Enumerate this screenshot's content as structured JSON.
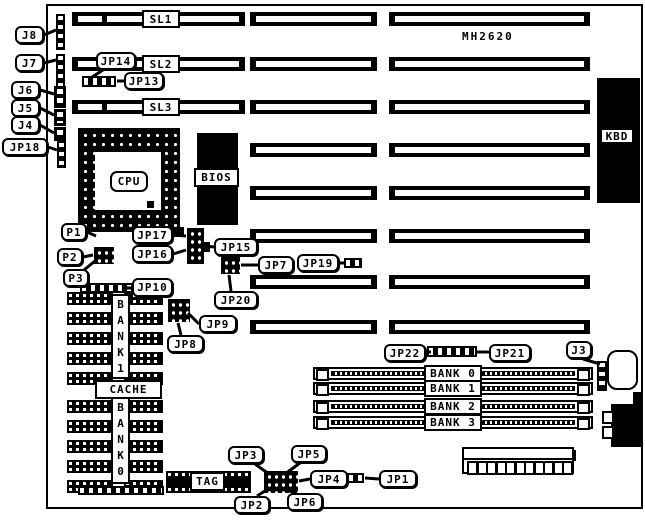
{
  "board": {
    "model": "MH2620"
  },
  "labels": {
    "cpu": "CPU",
    "bios": "BIOS",
    "kbd": "KBD",
    "cache": "CACHE",
    "tag": "TAG",
    "bank1_vertical": "BANK1",
    "bank0_vertical": "BANK0"
  },
  "slot_labels": [
    "SL1",
    "SL2",
    "SL3"
  ],
  "simm_banks": [
    "BANK 0",
    "BANK 1",
    "BANK 2",
    "BANK 3"
  ],
  "callouts": [
    {
      "id": "j8",
      "label": "J8"
    },
    {
      "id": "j7",
      "label": "J7"
    },
    {
      "id": "j6",
      "label": "J6"
    },
    {
      "id": "j5",
      "label": "J5"
    },
    {
      "id": "j4",
      "label": "J4"
    },
    {
      "id": "jp18",
      "label": "JP18"
    },
    {
      "id": "jp14",
      "label": "JP14"
    },
    {
      "id": "jp13",
      "label": "JP13"
    },
    {
      "id": "p1",
      "label": "P1"
    },
    {
      "id": "p2",
      "label": "P2"
    },
    {
      "id": "p3",
      "label": "P3"
    },
    {
      "id": "jp17",
      "label": "JP17"
    },
    {
      "id": "jp16",
      "label": "JP16"
    },
    {
      "id": "jp15",
      "label": "JP15"
    },
    {
      "id": "jp10",
      "label": "JP10"
    },
    {
      "id": "jp7",
      "label": "JP7"
    },
    {
      "id": "jp19",
      "label": "JP19"
    },
    {
      "id": "jp20",
      "label": "JP20"
    },
    {
      "id": "jp9",
      "label": "JP9"
    },
    {
      "id": "jp8",
      "label": "JP8"
    },
    {
      "id": "jp22",
      "label": "JP22"
    },
    {
      "id": "jp21",
      "label": "JP21"
    },
    {
      "id": "j3",
      "label": "J3"
    },
    {
      "id": "jp3",
      "label": "JP3"
    },
    {
      "id": "jp5",
      "label": "JP5"
    },
    {
      "id": "jp4",
      "label": "JP4"
    },
    {
      "id": "jp2",
      "label": "JP2"
    },
    {
      "id": "jp6",
      "label": "JP6"
    },
    {
      "id": "jp1",
      "label": "JP1"
    }
  ],
  "colors": {
    "ink": "#000000",
    "paper": "#ffffff"
  }
}
